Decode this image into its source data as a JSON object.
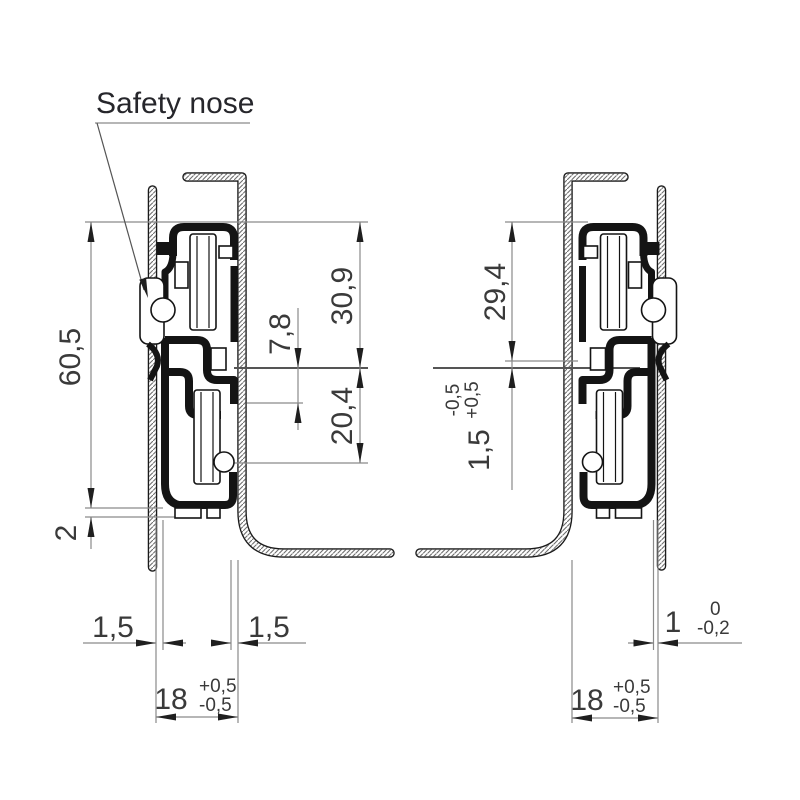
{
  "annotation": {
    "safety_nose": "Safety nose"
  },
  "left_view": {
    "height_total": "60,5",
    "foot_height": "2",
    "upper_height": "30,9",
    "mid_offset": "7,8",
    "lower_height": "20,4",
    "clearance_left": "1,5",
    "clearance_right": "1,5",
    "width": "18",
    "width_tol_plus": "+0,5",
    "width_tol_minus": "-0,5"
  },
  "right_view": {
    "upper_height": "29,4",
    "offset": "1,5",
    "offset_tol_plus": "+0,5",
    "offset_tol_minus": "-0,5",
    "gap": "1",
    "gap_tol_plus": "0",
    "gap_tol_minus": "-0,2",
    "width": "18",
    "width_tol_plus": "+0,5",
    "width_tol_minus": "-0,5"
  },
  "colors": {
    "ink": "#141414",
    "dim_line": "#8a8a8a",
    "text": "#3a3a3a"
  }
}
